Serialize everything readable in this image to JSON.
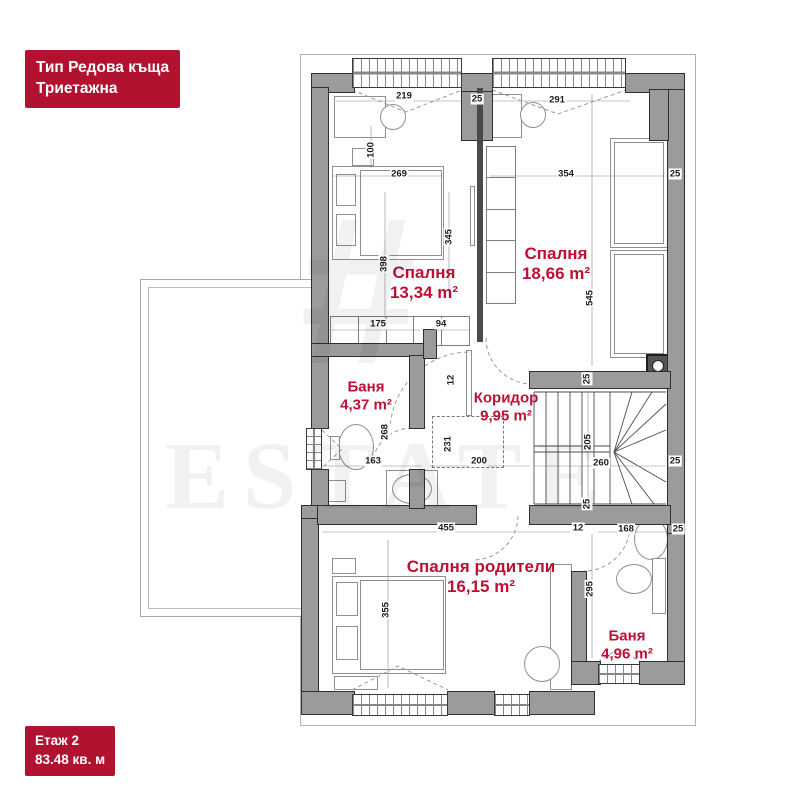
{
  "colors": {
    "badge_red": "#b01230",
    "label_red": "#bc1134",
    "wall_gray": "#9b9b9b"
  },
  "title_badge": {
    "line1": "Тип Редова къща",
    "line2": "Триетажна"
  },
  "floor_badge": {
    "line1": "Етаж 2",
    "line2": "83.48 кв. м"
  },
  "watermark": {
    "logo": "#",
    "text": "ESTATE"
  },
  "rooms": [
    {
      "name": "Спалня",
      "area": "13,34 m²",
      "x": 424,
      "y": 283,
      "size": 17
    },
    {
      "name": "Спалня",
      "area": "18,66 m²",
      "x": 556,
      "y": 264,
      "size": 17
    },
    {
      "name": "Баня",
      "area": "4,37 m²",
      "x": 366,
      "y": 396,
      "size": 15
    },
    {
      "name": "Коридор",
      "area": "9,95 m²",
      "x": 506,
      "y": 407,
      "size": 15
    },
    {
      "name": "Спалня родители",
      "area": "16,15 m²",
      "x": 481,
      "y": 577,
      "size": 17
    },
    {
      "name": "Баня",
      "area": "4,96 m²",
      "x": 627,
      "y": 645,
      "size": 15
    }
  ],
  "dimensions": [
    {
      "t": "219",
      "x": 404,
      "y": 96
    },
    {
      "t": "25",
      "x": 477,
      "y": 99
    },
    {
      "t": "291",
      "x": 557,
      "y": 100
    },
    {
      "t": "100",
      "x": 371,
      "y": 150,
      "rot": 1
    },
    {
      "t": "269",
      "x": 399,
      "y": 174
    },
    {
      "t": "398",
      "x": 384,
      "y": 264,
      "rot": 1
    },
    {
      "t": "345",
      "x": 449,
      "y": 237,
      "rot": 1
    },
    {
      "t": "354",
      "x": 566,
      "y": 174
    },
    {
      "t": "545",
      "x": 590,
      "y": 298,
      "rot": 1
    },
    {
      "t": "25",
      "x": 675,
      "y": 174
    },
    {
      "t": "175",
      "x": 378,
      "y": 324
    },
    {
      "t": "94",
      "x": 441,
      "y": 324
    },
    {
      "t": "12",
      "x": 451,
      "y": 380,
      "rot": 1
    },
    {
      "t": "268",
      "x": 385,
      "y": 432,
      "rot": 1
    },
    {
      "t": "163",
      "x": 373,
      "y": 461
    },
    {
      "t": "231",
      "x": 448,
      "y": 444,
      "rot": 1
    },
    {
      "t": "200",
      "x": 479,
      "y": 461
    },
    {
      "t": "205",
      "x": 588,
      "y": 442,
      "rot": 1
    },
    {
      "t": "260",
      "x": 601,
      "y": 463
    },
    {
      "t": "25",
      "x": 675,
      "y": 461
    },
    {
      "t": "25",
      "x": 587,
      "y": 379,
      "rot": 1
    },
    {
      "t": "25",
      "x": 587,
      "y": 504,
      "rot": 1
    },
    {
      "t": "455",
      "x": 446,
      "y": 528
    },
    {
      "t": "12",
      "x": 578,
      "y": 528
    },
    {
      "t": "355",
      "x": 386,
      "y": 610,
      "rot": 1
    },
    {
      "t": "295",
      "x": 590,
      "y": 589,
      "rot": 1
    },
    {
      "t": "168",
      "x": 626,
      "y": 529
    },
    {
      "t": "25",
      "x": 678,
      "y": 529
    }
  ],
  "plan": {
    "outline": {
      "x": 300,
      "y": 54,
      "w": 396,
      "h": 672
    },
    "terrace": {
      "x": 140,
      "y": 279,
      "w": 178,
      "h": 338
    },
    "walls": [
      [
        312,
        74,
        42,
        18
      ],
      [
        462,
        74,
        30,
        18
      ],
      [
        626,
        74,
        58,
        18
      ],
      [
        312,
        88,
        16,
        258
      ],
      [
        312,
        346,
        16,
        82
      ],
      [
        312,
        470,
        16,
        44
      ],
      [
        302,
        514,
        16,
        192
      ],
      [
        302,
        506,
        28,
        12
      ],
      [
        668,
        90,
        16,
        444
      ],
      [
        668,
        534,
        16,
        150
      ],
      [
        650,
        90,
        18,
        50
      ],
      [
        530,
        372,
        140,
        16
      ],
      [
        530,
        506,
        140,
        18
      ],
      [
        318,
        506,
        158,
        18
      ],
      [
        312,
        344,
        112,
        12
      ],
      [
        410,
        356,
        14,
        72
      ],
      [
        410,
        470,
        14,
        38
      ],
      [
        572,
        572,
        14,
        92
      ],
      [
        572,
        662,
        28,
        22
      ],
      [
        640,
        662,
        44,
        22
      ],
      [
        302,
        692,
        52,
        22
      ],
      [
        448,
        692,
        46,
        22
      ],
      [
        530,
        692,
        64,
        22
      ],
      [
        462,
        92,
        30,
        48
      ],
      [
        424,
        330,
        12,
        28
      ]
    ],
    "thin_walls": [
      [
        477,
        88,
        6,
        254
      ]
    ],
    "windows": [
      {
        "x": 352,
        "y": 58,
        "w": 110,
        "h": 30,
        "o": "h"
      },
      {
        "x": 492,
        "y": 58,
        "w": 134,
        "h": 30,
        "o": "h"
      },
      {
        "x": 306,
        "y": 428,
        "w": 16,
        "h": 42,
        "o": "v"
      },
      {
        "x": 352,
        "y": 694,
        "w": 96,
        "h": 22,
        "o": "h"
      },
      {
        "x": 494,
        "y": 694,
        "w": 36,
        "h": 22,
        "o": "h"
      },
      {
        "x": 598,
        "y": 664,
        "w": 42,
        "h": 20,
        "o": "h"
      }
    ],
    "furniture": [
      {
        "k": "rect",
        "n": "desk",
        "x": 334,
        "y": 96,
        "w": 52,
        "h": 42
      },
      {
        "k": "oval",
        "n": "chair",
        "x": 380,
        "y": 104,
        "w": 26,
        "h": 26
      },
      {
        "k": "rect",
        "n": "nightstand",
        "x": 352,
        "y": 148,
        "w": 22,
        "h": 18
      },
      {
        "k": "rect",
        "n": "double-bed",
        "x": 332,
        "y": 166,
        "w": 112,
        "h": 94
      },
      {
        "k": "rect",
        "n": "mattress",
        "x": 360,
        "y": 170,
        "w": 82,
        "h": 86
      },
      {
        "k": "rect",
        "n": "pillow",
        "x": 336,
        "y": 174,
        "w": 20,
        "h": 32
      },
      {
        "k": "rect",
        "n": "pillow",
        "x": 336,
        "y": 214,
        "w": 20,
        "h": 32
      },
      {
        "k": "rect",
        "n": "door-leaf",
        "x": 470,
        "y": 186,
        "w": 5,
        "h": 60
      },
      {
        "k": "rect",
        "n": "desk",
        "x": 492,
        "y": 94,
        "w": 30,
        "h": 44
      },
      {
        "k": "oval",
        "n": "chair",
        "x": 520,
        "y": 102,
        "w": 26,
        "h": 26
      },
      {
        "k": "cells-v",
        "n": "wardrobe",
        "x": 486,
        "y": 146,
        "w": 30,
        "h": 158,
        "cells": 5
      },
      {
        "k": "rect",
        "n": "single-bed",
        "x": 610,
        "y": 138,
        "w": 58,
        "h": 110
      },
      {
        "k": "rect",
        "n": "mattress",
        "x": 614,
        "y": 142,
        "w": 50,
        "h": 102
      },
      {
        "k": "rect",
        "n": "single-bed",
        "x": 610,
        "y": 250,
        "w": 58,
        "h": 108
      },
      {
        "k": "rect",
        "n": "mattress",
        "x": 614,
        "y": 254,
        "w": 50,
        "h": 100
      },
      {
        "k": "shaft",
        "n": "shaft",
        "x": 646,
        "y": 354,
        "w": 24,
        "h": 24
      },
      {
        "k": "cells-h",
        "n": "closet",
        "x": 330,
        "y": 316,
        "w": 140,
        "h": 30,
        "cells": 5
      },
      {
        "k": "dash",
        "n": "void",
        "x": 432,
        "y": 416,
        "w": 72,
        "h": 52
      },
      {
        "k": "rect",
        "n": "door-leaf",
        "x": 466,
        "y": 350,
        "w": 6,
        "h": 66
      },
      {
        "k": "rect",
        "n": "radiator",
        "x": 314,
        "y": 358,
        "w": 10,
        "h": 66
      },
      {
        "k": "oval",
        "n": "toilet",
        "x": 338,
        "y": 424,
        "w": 36,
        "h": 46
      },
      {
        "k": "rect",
        "n": "cistern",
        "x": 330,
        "y": 436,
        "w": 10,
        "h": 24
      },
      {
        "k": "rect",
        "n": "sink-counter",
        "x": 386,
        "y": 470,
        "w": 52,
        "h": 38
      },
      {
        "k": "oval",
        "n": "sink",
        "x": 392,
        "y": 474,
        "w": 40,
        "h": 30
      },
      {
        "k": "rect",
        "n": "washing-machine",
        "x": 324,
        "y": 480,
        "w": 22,
        "h": 22
      },
      {
        "k": "rect",
        "n": "nightstand",
        "x": 332,
        "y": 558,
        "w": 24,
        "h": 16
      },
      {
        "k": "rect",
        "n": "double-bed",
        "x": 332,
        "y": 576,
        "w": 114,
        "h": 98
      },
      {
        "k": "rect",
        "n": "mattress",
        "x": 360,
        "y": 580,
        "w": 84,
        "h": 90
      },
      {
        "k": "rect",
        "n": "pillow",
        "x": 336,
        "y": 582,
        "w": 22,
        "h": 34
      },
      {
        "k": "rect",
        "n": "pillow",
        "x": 336,
        "y": 626,
        "w": 22,
        "h": 34
      },
      {
        "k": "rect",
        "n": "bench",
        "x": 334,
        "y": 676,
        "w": 44,
        "h": 14
      },
      {
        "k": "rect",
        "n": "desk",
        "x": 550,
        "y": 564,
        "w": 22,
        "h": 126
      },
      {
        "k": "oval",
        "n": "chair",
        "x": 524,
        "y": 646,
        "w": 36,
        "h": 36
      },
      {
        "k": "oval",
        "n": "sink",
        "x": 634,
        "y": 518,
        "w": 34,
        "h": 42
      },
      {
        "k": "oval",
        "n": "toilet",
        "x": 616,
        "y": 564,
        "w": 36,
        "h": 30
      },
      {
        "k": "rect",
        "n": "cabinet",
        "x": 652,
        "y": 558,
        "w": 14,
        "h": 56
      }
    ],
    "segments": [
      [
        534,
        392,
        666,
        392,
        "st"
      ],
      [
        534,
        504,
        666,
        504,
        "st"
      ],
      [
        534,
        392,
        534,
        504,
        "st"
      ],
      [
        546,
        392,
        546,
        504,
        "st"
      ],
      [
        558,
        392,
        558,
        504,
        "st"
      ],
      [
        570,
        392,
        570,
        504,
        "st"
      ],
      [
        582,
        392,
        582,
        504,
        "st"
      ],
      [
        594,
        392,
        594,
        504,
        "st"
      ],
      [
        534,
        446,
        610,
        446,
        "st"
      ],
      [
        534,
        452,
        610,
        452,
        "st"
      ],
      [
        610,
        392,
        610,
        504,
        "st"
      ],
      [
        614,
        452,
        632,
        392,
        "st"
      ],
      [
        614,
        452,
        652,
        392,
        "st"
      ],
      [
        614,
        452,
        666,
        404,
        "st"
      ],
      [
        614,
        452,
        666,
        430,
        "st"
      ],
      [
        614,
        452,
        666,
        482,
        "st"
      ],
      [
        614,
        452,
        654,
        504,
        "st"
      ],
      [
        614,
        452,
        632,
        504,
        "st"
      ],
      [
        336,
        101,
        630,
        101,
        "dim"
      ],
      [
        332,
        176,
        444,
        176,
        "dim"
      ],
      [
        490,
        176,
        664,
        176,
        "dim"
      ],
      [
        592,
        94,
        592,
        366,
        "dim"
      ],
      [
        385,
        192,
        385,
        328,
        "dim"
      ],
      [
        449,
        192,
        449,
        298,
        "dim"
      ],
      [
        371,
        126,
        371,
        168,
        "dim"
      ],
      [
        332,
        330,
        420,
        330,
        "dim"
      ],
      [
        430,
        330,
        470,
        330,
        "dim"
      ],
      [
        322,
        466,
        422,
        466,
        "dim"
      ],
      [
        430,
        466,
        530,
        466,
        "dim"
      ],
      [
        588,
        392,
        588,
        504,
        "dim"
      ],
      [
        534,
        466,
        666,
        466,
        "dim"
      ],
      [
        322,
        532,
        570,
        532,
        "dim"
      ],
      [
        388,
        540,
        388,
        688,
        "dim"
      ],
      [
        592,
        534,
        592,
        658,
        "dim"
      ],
      [
        598,
        532,
        668,
        532,
        "dim"
      ],
      [
        666,
        176,
        686,
        176,
        "dim"
      ],
      [
        666,
        460,
        686,
        460,
        "dim"
      ],
      [
        666,
        529,
        686,
        529,
        "dim"
      ]
    ],
    "paths": [
      {
        "d": "M 352 90 L 406 112 L 462 90"
      },
      {
        "d": "M 492 90 L 558 114 L 626 90"
      },
      {
        "d": "M 352 690 L 398 666 L 448 690"
      },
      {
        "d": "M 598 662 L 619 648 L 640 662"
      },
      {
        "d": "M 322 430 L 342 449 L 322 468"
      },
      {
        "d": "M 468 352 A 80 80 0 0 0 390 430"
      },
      {
        "d": "M 486 338 A 46 46 0 0 0 532 384"
      },
      {
        "d": "M 518 516 A 45 45 0 0 1 473 560"
      },
      {
        "d": "M 630 526 A 46 46 0 0 1 584 571"
      },
      {
        "d": "M 412 428 A 40 40 0 0 0 372 468"
      }
    ]
  }
}
